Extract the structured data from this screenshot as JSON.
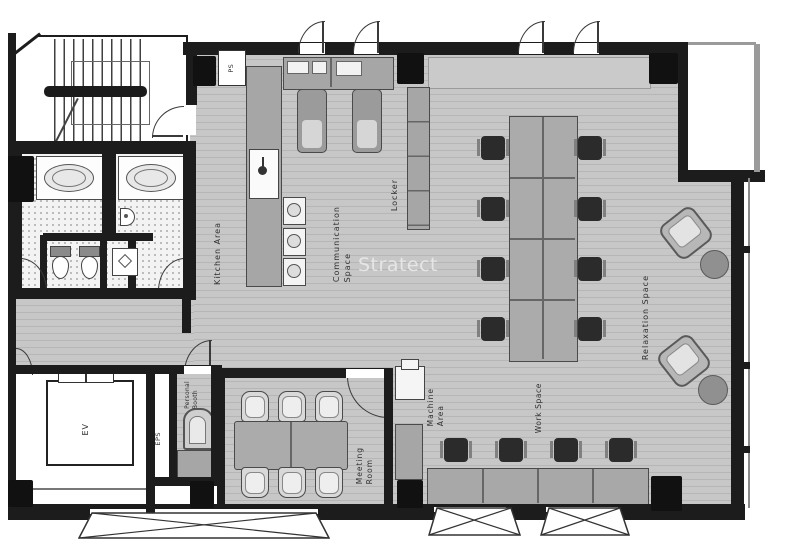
{
  "watermark": "Stratect",
  "labels": {
    "ps": "PS",
    "kitchen": "Kitchen Area",
    "communication": [
      "Communication",
      "Space"
    ],
    "locker": "Locker",
    "relaxation": "Relaxation Space",
    "machine": [
      "Machine",
      "Area"
    ],
    "work": "Work Space",
    "meeting": [
      "Meeting",
      "Room"
    ],
    "personal": [
      "Personal",
      "Booth"
    ],
    "eps": "EPS",
    "ev": "EV"
  },
  "colors": {
    "wall": "#1c1c1c",
    "floor": "#c7c7c7",
    "floor_stripe": "#b6b6b6",
    "furniture_gray": "#a6a6a6",
    "chair_dark": "#2b2b2b",
    "label_text": "#2e2e2e",
    "watermark_text": "#ececec"
  }
}
